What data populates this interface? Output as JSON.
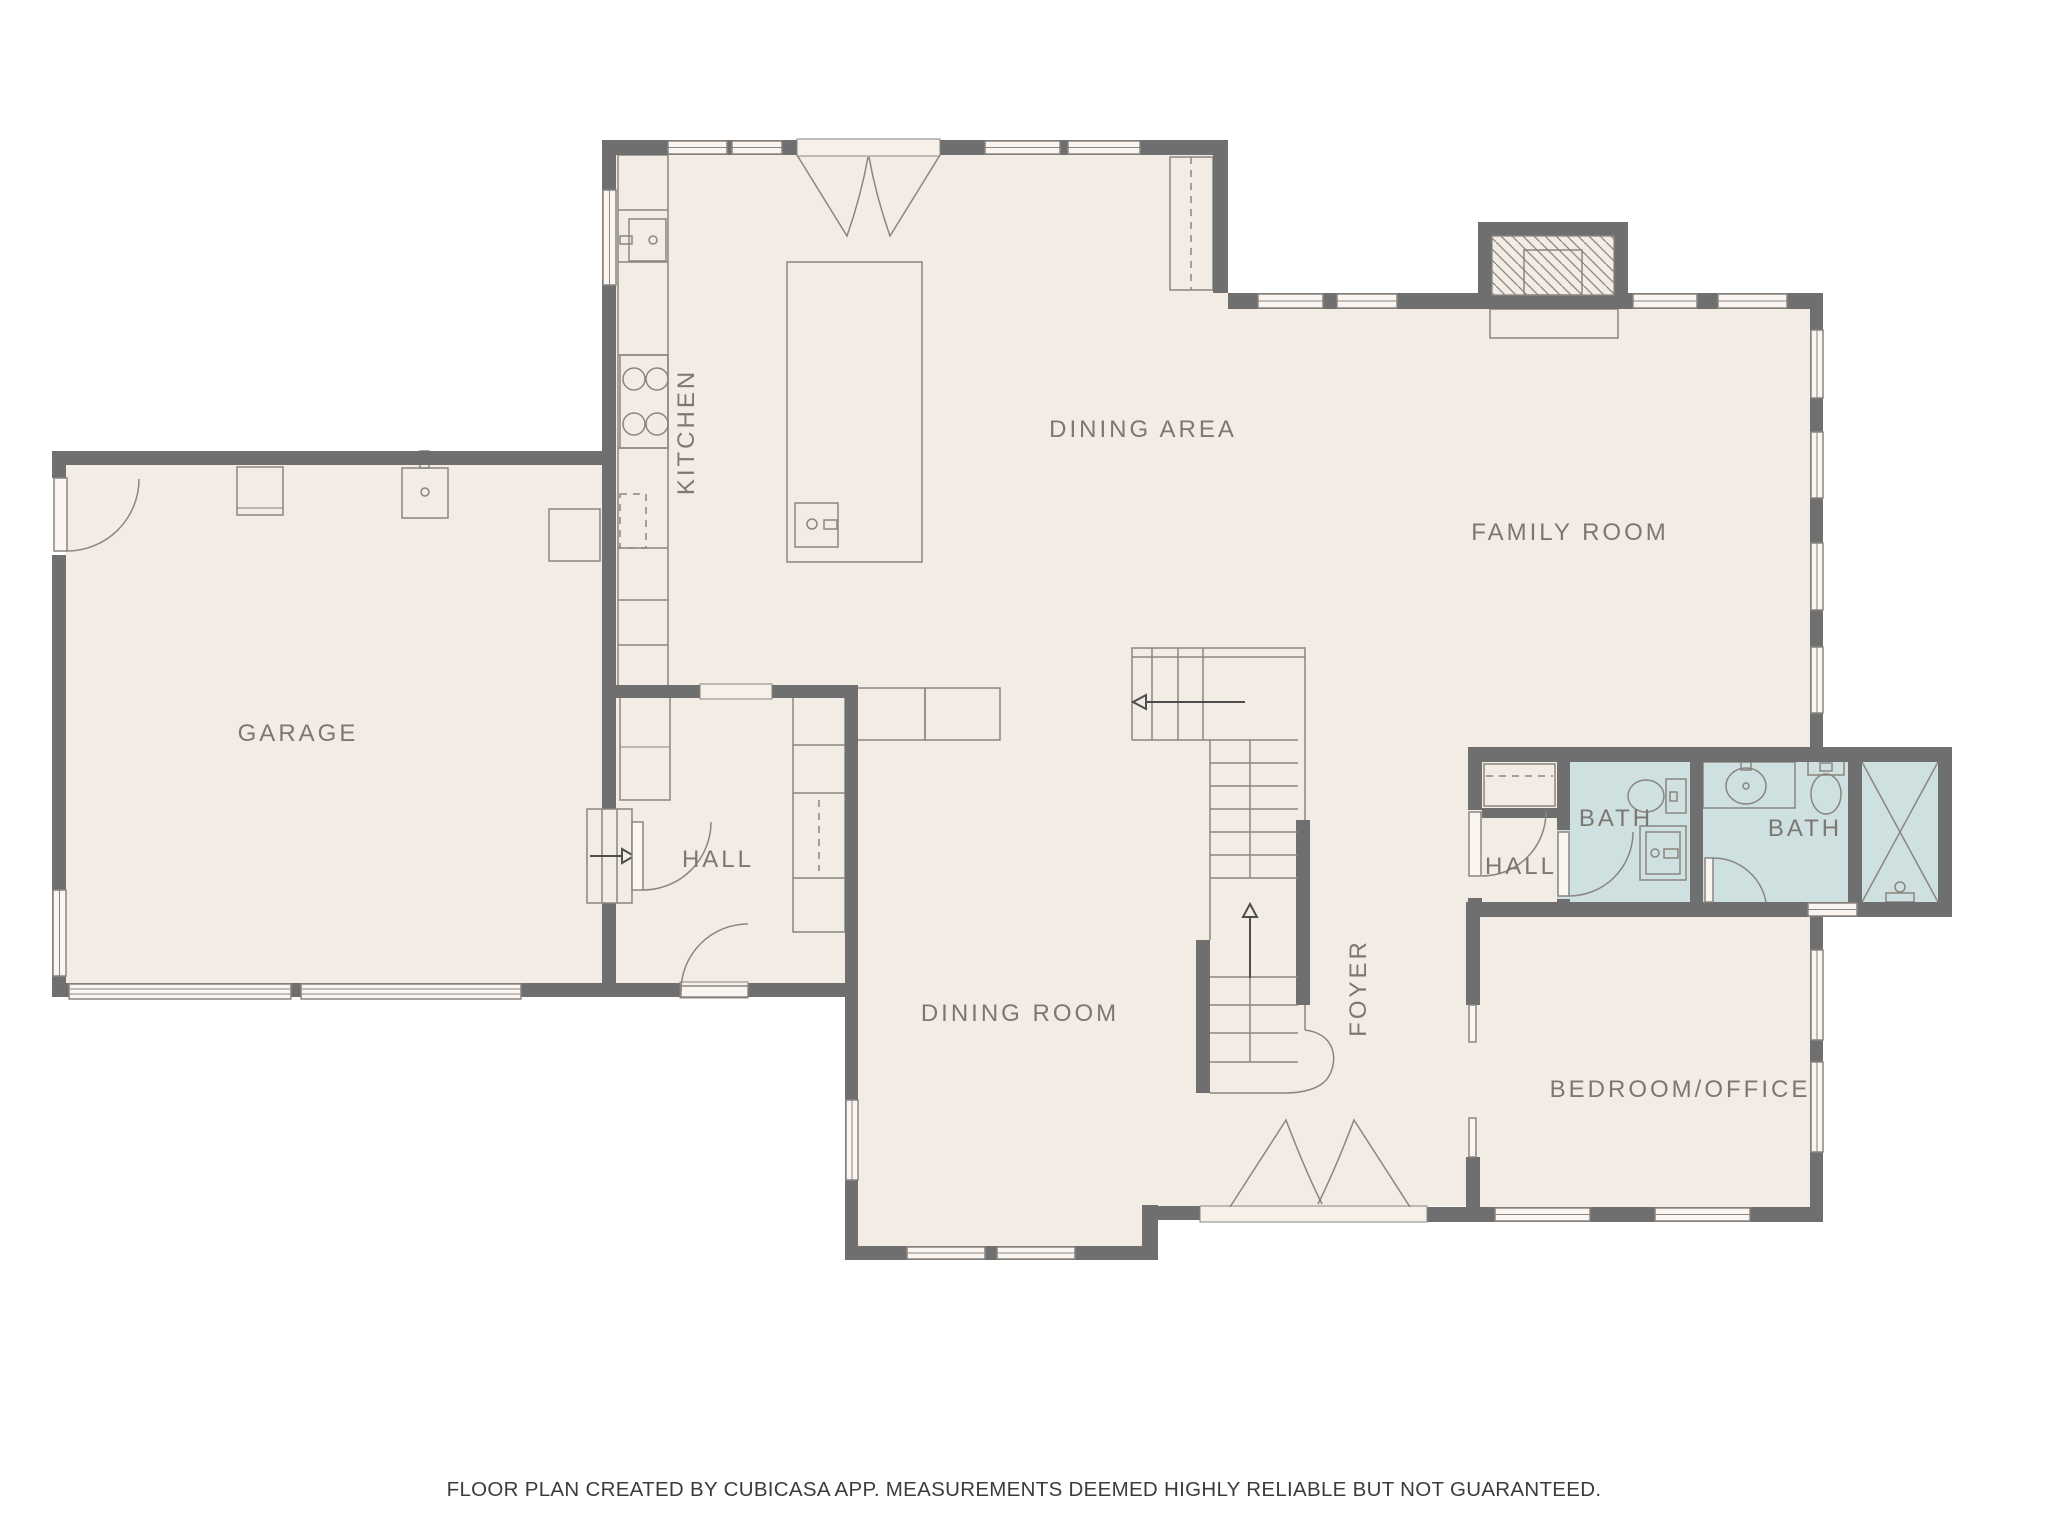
{
  "title": "First floor plan",
  "colors": {
    "background": "#ffffff",
    "floor": "#f3ece5",
    "wall": "#6f6f6f",
    "fixture_line": "#8a8580",
    "bathroom_fill": "#cfe0e1",
    "room_label": "#7c7771",
    "footer_text": "#3b3b3b",
    "window_fill": "#faf5f0"
  },
  "rooms": {
    "garage": {
      "label": "GARAGE"
    },
    "kitchen": {
      "label": "KITCHEN"
    },
    "dining_area": {
      "label": "DINING AREA"
    },
    "family_room": {
      "label": "FAMILY ROOM"
    },
    "hall_mud": {
      "label": "HALL"
    },
    "dining_room": {
      "label": "DINING ROOM"
    },
    "foyer": {
      "label": "FOYER"
    },
    "hall_bath": {
      "label": "HALL"
    },
    "bath_small": {
      "label": "BATH"
    },
    "bath_main": {
      "label": "BATH"
    },
    "bedroom_office": {
      "label": "BEDROOM/OFFICE"
    }
  },
  "fixtures": [
    "garage-entry-door",
    "garage-sink",
    "garage-shelf",
    "water-heater",
    "garage-overhead-doors",
    "kitchen-sink",
    "cooktop",
    "dishwasher",
    "kitchen-cabinets",
    "kitchen-island",
    "island-sink",
    "patio-double-door",
    "fireplace",
    "hearth",
    "pantry-cabinets",
    "built-in-bench",
    "staircase",
    "stair-up-arrow",
    "step-arrow",
    "garage-steps",
    "closet-rod",
    "toilet",
    "shower-stall",
    "vanity-sink",
    "shower-enclosure",
    "entry-double-door",
    "pocket-doors",
    "windows"
  ],
  "footer": {
    "text": "FLOOR PLAN CREATED BY CUBICASA APP. MEASUREMENTS DEEMED HIGHLY RELIABLE BUT NOT GUARANTEED."
  }
}
